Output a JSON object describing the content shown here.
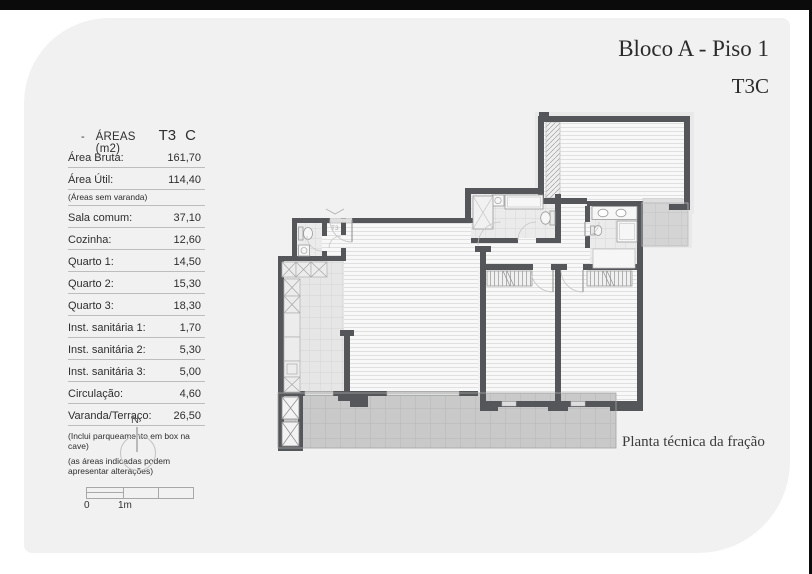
{
  "titles": {
    "line1": "Bloco A - Piso 1",
    "line2": "T3C",
    "caption": "Planta técnica da fração"
  },
  "areas_table": {
    "header": {
      "dash": "-",
      "title": "ÁREAS (m2)",
      "typology": "T3",
      "fraction": "C"
    },
    "summary_rows": [
      {
        "label": "Área Bruta:",
        "value": "161,70"
      },
      {
        "label": "Área Útil:",
        "value": "114,40"
      }
    ],
    "summary_note": "(Áreas sem varanda)",
    "rows": [
      {
        "label": "Sala comum:",
        "value": "37,10"
      },
      {
        "label": "Cozinha:",
        "value": "12,60"
      },
      {
        "label": "Quarto 1:",
        "value": "14,50"
      },
      {
        "label": "Quarto 2:",
        "value": "15,30"
      },
      {
        "label": "Quarto 3:",
        "value": "18,30"
      },
      {
        "label": "Inst. sanitária 1:",
        "value": "1,70"
      },
      {
        "label": "Inst. sanitária 2:",
        "value": "5,30"
      },
      {
        "label": "Inst. sanitária 3:",
        "value": "5,00"
      },
      {
        "label": "Circulação:",
        "value": "4,60"
      },
      {
        "label": "Varanda/Terraço:",
        "value": "26,50"
      }
    ],
    "footnotes": [
      "(Inclui parqueamento em box na cave)",
      "(as áreas indicadas podem apresentar alterações)"
    ]
  },
  "compass": {
    "north_label": "N"
  },
  "scale_bar": {
    "start_label": "0",
    "meter_label": "1m"
  },
  "floor_plan": {
    "entrance_label": "T3"
  },
  "colors": {
    "wall": "#55565a",
    "sheet": "#f1f1f1",
    "balcony": "#c9c9c9",
    "terrace": "#d4d4d4"
  }
}
